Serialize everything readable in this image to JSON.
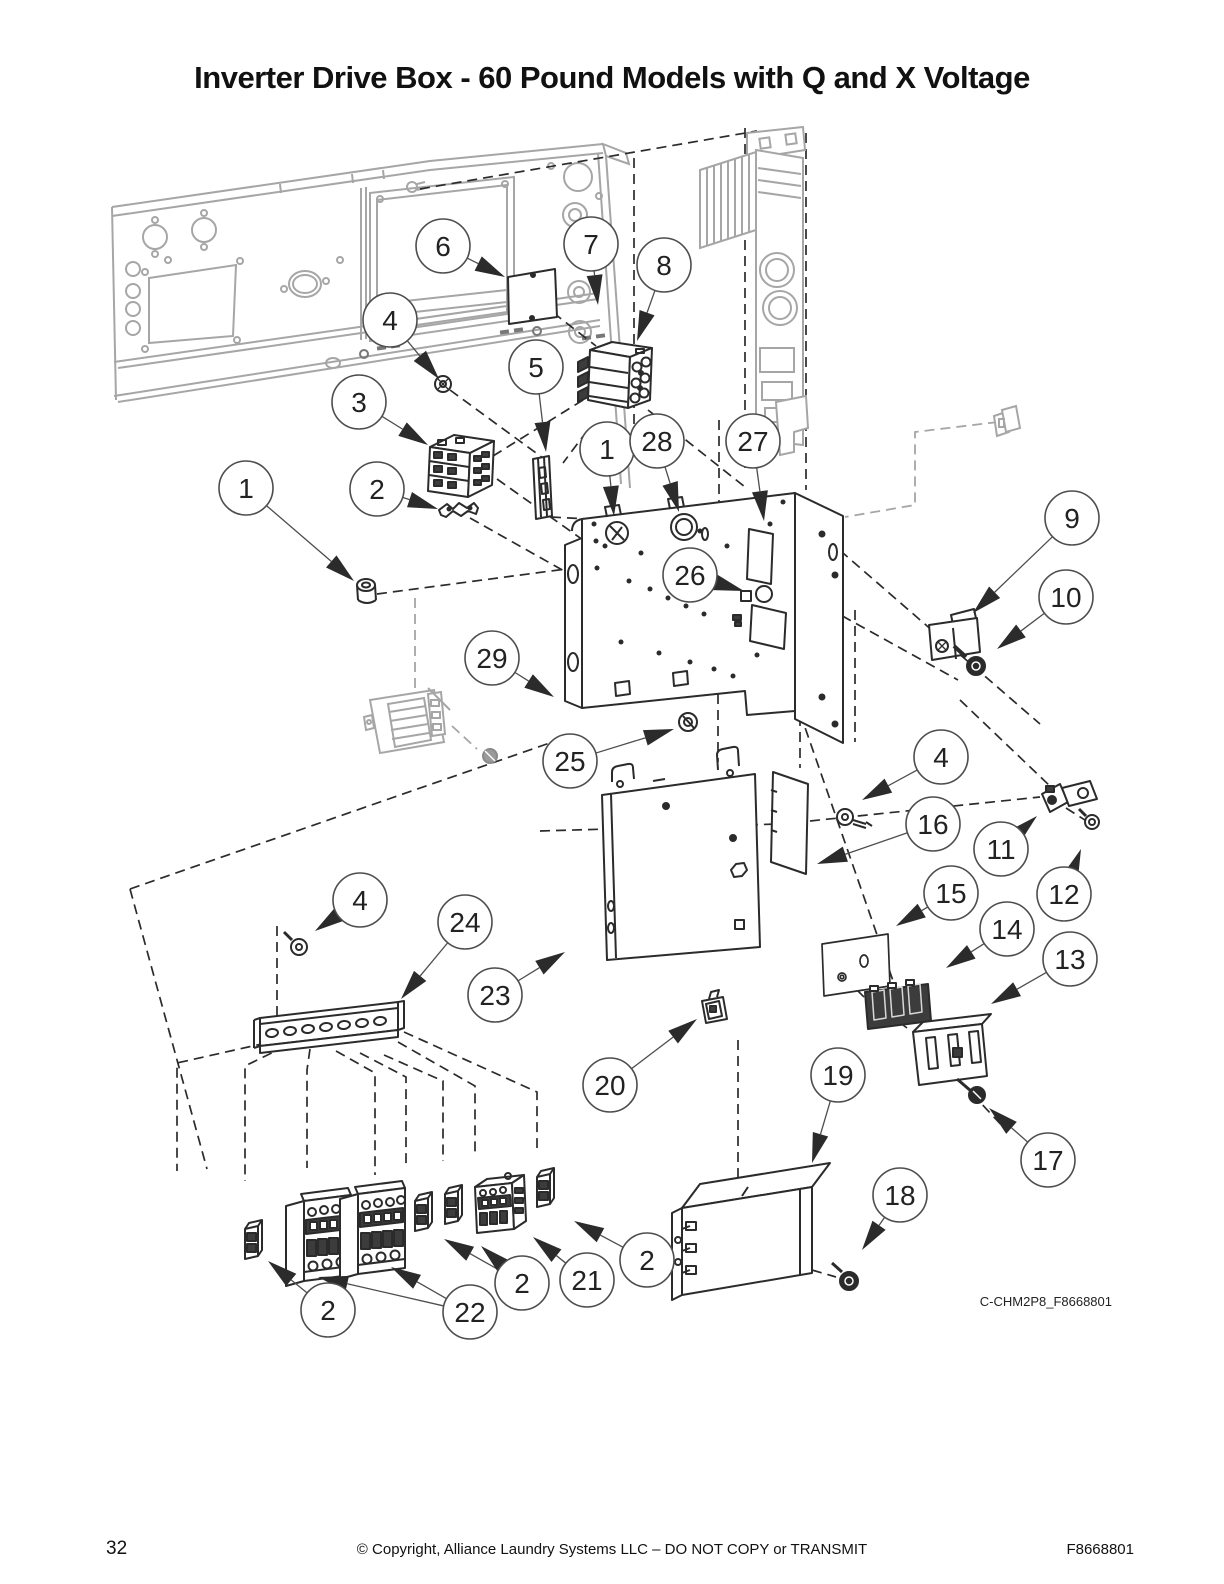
{
  "title": "Inverter Drive Box - 60 Pound Models with Q and X Voltage",
  "figure": {
    "code": "C-CHM2P8_F8668801"
  },
  "footer": {
    "page_number": "32",
    "copyright": "© Copyright, Alliance Laundry Systems LLC – DO NOT COPY or TRANSMIT",
    "document_number": "F8668801"
  },
  "diagram": {
    "type": "exploded-parts-diagram",
    "colors": {
      "line": "#2b2b2b",
      "phantom": "#a6a6a6",
      "leader": "#4d4d4d",
      "dark_fill": "#3c3c3c"
    },
    "callout_radius": 27,
    "callouts": [
      {
        "label": "6",
        "cx": 443,
        "cy": 246,
        "tips": [
          [
            505,
            277
          ]
        ]
      },
      {
        "label": "7",
        "cx": 591,
        "cy": 244,
        "tips": [
          [
            598,
            305
          ]
        ]
      },
      {
        "label": "8",
        "cx": 664,
        "cy": 265,
        "tips": [
          [
            637,
            341
          ]
        ]
      },
      {
        "label": "4",
        "cx": 390,
        "cy": 320,
        "tips": [
          [
            439,
            379
          ]
        ]
      },
      {
        "label": "5",
        "cx": 536,
        "cy": 367,
        "tips": [
          [
            546,
            452
          ]
        ]
      },
      {
        "label": "3",
        "cx": 359,
        "cy": 402,
        "tips": [
          [
            428,
            445
          ]
        ]
      },
      {
        "label": "1",
        "cx": 246,
        "cy": 488,
        "tips": [
          [
            354,
            581
          ]
        ]
      },
      {
        "label": "2",
        "cx": 377,
        "cy": 489,
        "tips": [
          [
            438,
            509
          ]
        ]
      },
      {
        "label": "1",
        "cx": 607,
        "cy": 449,
        "tips": [
          [
            614,
            516
          ]
        ]
      },
      {
        "label": "28",
        "cx": 657,
        "cy": 441,
        "tips": [
          [
            679,
            512
          ]
        ]
      },
      {
        "label": "27",
        "cx": 753,
        "cy": 441,
        "tips": [
          [
            764,
            521
          ]
        ]
      },
      {
        "label": "26",
        "cx": 690,
        "cy": 575,
        "tips": [
          [
            744,
            591
          ]
        ]
      },
      {
        "label": "9",
        "cx": 1072,
        "cy": 518,
        "tips": [
          [
            973,
            613
          ]
        ]
      },
      {
        "label": "10",
        "cx": 1066,
        "cy": 597,
        "tips": [
          [
            997,
            649
          ]
        ]
      },
      {
        "label": "29",
        "cx": 492,
        "cy": 658,
        "tips": [
          [
            554,
            697
          ]
        ]
      },
      {
        "label": "25",
        "cx": 570,
        "cy": 761,
        "tips": [
          [
            674,
            729
          ]
        ]
      },
      {
        "label": "4",
        "cx": 941,
        "cy": 757,
        "tips": [
          [
            862,
            800
          ]
        ]
      },
      {
        "label": "16",
        "cx": 933,
        "cy": 824,
        "tips": [
          [
            817,
            864
          ]
        ]
      },
      {
        "label": "11",
        "cx": 1001,
        "cy": 849,
        "tips": [
          [
            1037,
            816
          ]
        ]
      },
      {
        "label": "12",
        "cx": 1064,
        "cy": 894,
        "tips": [
          [
            1081,
            849
          ]
        ]
      },
      {
        "label": "15",
        "cx": 951,
        "cy": 893,
        "tips": [
          [
            896,
            926
          ]
        ]
      },
      {
        "label": "14",
        "cx": 1007,
        "cy": 929,
        "tips": [
          [
            946,
            968
          ]
        ]
      },
      {
        "label": "13",
        "cx": 1070,
        "cy": 959,
        "tips": [
          [
            991,
            1004
          ]
        ]
      },
      {
        "label": "4",
        "cx": 360,
        "cy": 900,
        "tips": [
          [
            315,
            931
          ]
        ]
      },
      {
        "label": "24",
        "cx": 465,
        "cy": 922,
        "tips": [
          [
            401,
            999
          ]
        ]
      },
      {
        "label": "23",
        "cx": 495,
        "cy": 995,
        "tips": [
          [
            565,
            952
          ]
        ]
      },
      {
        "label": "20",
        "cx": 610,
        "cy": 1085,
        "tips": [
          [
            697,
            1019
          ]
        ]
      },
      {
        "label": "19",
        "cx": 838,
        "cy": 1075,
        "tips": [
          [
            812,
            1163
          ]
        ]
      },
      {
        "label": "18",
        "cx": 900,
        "cy": 1195,
        "tips": [
          [
            862,
            1250
          ]
        ]
      },
      {
        "label": "17",
        "cx": 1048,
        "cy": 1160,
        "tips": [
          [
            989,
            1108
          ]
        ]
      },
      {
        "label": "2",
        "cx": 647,
        "cy": 1260,
        "tips": [
          [
            574,
            1221
          ]
        ]
      },
      {
        "label": "21",
        "cx": 587,
        "cy": 1280,
        "tips": [
          [
            533,
            1237
          ]
        ]
      },
      {
        "label": "2",
        "cx": 522,
        "cy": 1283,
        "tips": [
          [
            444,
            1239
          ],
          [
            481,
            1246
          ]
        ]
      },
      {
        "label": "22",
        "cx": 470,
        "cy": 1312,
        "tips": [
          [
            318,
            1277
          ],
          [
            391,
            1267
          ]
        ]
      },
      {
        "label": "2",
        "cx": 328,
        "cy": 1310,
        "tips": [
          [
            268,
            1261
          ]
        ]
      }
    ]
  }
}
